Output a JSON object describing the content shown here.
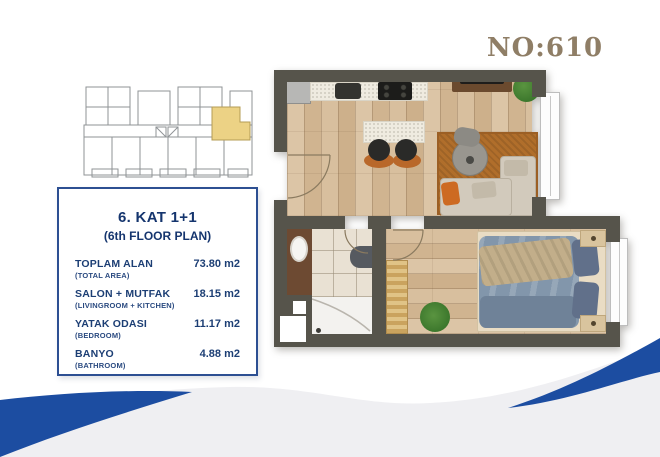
{
  "header": {
    "plan_number": "NO:610"
  },
  "info_panel": {
    "title": "6. KAT 1+1",
    "subtitle": "(6th FLOOR PLAN)",
    "rows": [
      {
        "label": "TOPLAM ALAN",
        "sublabel": "(TOTAL AREA)",
        "value": "73.80 m2"
      },
      {
        "label": "SALON + MUTFAK",
        "sublabel": "(LIVINGROOM + KITCHEN)",
        "value": "18.15 m2"
      },
      {
        "label": "YATAK ODASI",
        "sublabel": "(BEDROOM)",
        "value": "11.17 m2"
      },
      {
        "label": "BANYO",
        "sublabel": "(BATHROOM)",
        "value": "4.88 m2"
      }
    ]
  },
  "colors": {
    "accent_blue": "#1c4da1",
    "navy_text": "#15356e",
    "plan_number_brown": "#8f7e66",
    "wall": "#56544b",
    "wood_floor": "#d7bd9c",
    "bathroom_tile": "#e9e1d3",
    "key_plan_highlight": "#ecd285",
    "living_rug": "#b06e2b",
    "bottom_wave_gray": "#efeff2"
  }
}
